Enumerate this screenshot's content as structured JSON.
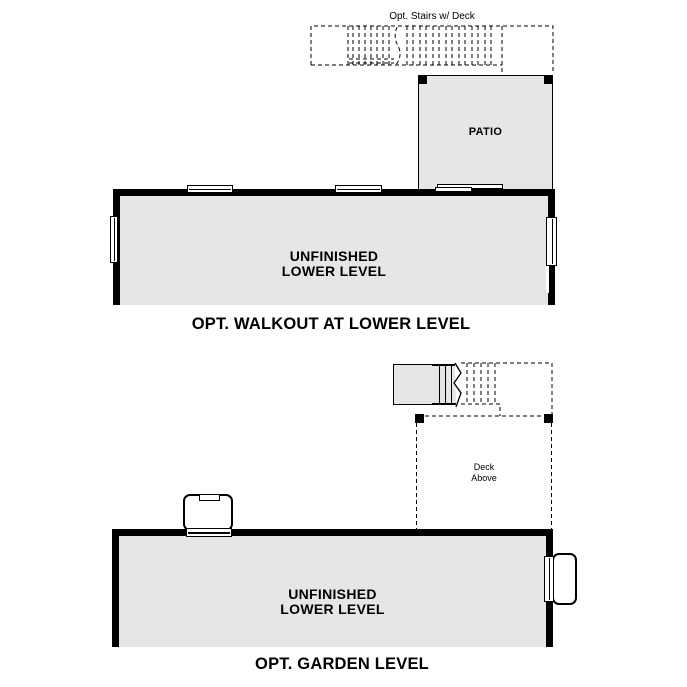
{
  "colors": {
    "room_fill": "#e6e6e6",
    "wall": "#000000",
    "background": "#ffffff"
  },
  "walkout": {
    "stairs_label": "Opt. Stairs w/ Deck",
    "patio_label": "PATIO",
    "room_label": [
      "UNFINISHED",
      "LOWER LEVEL"
    ],
    "caption": "OPT. WALKOUT AT LOWER LEVEL"
  },
  "garden": {
    "deck_label": [
      "Deck",
      "Above"
    ],
    "room_label": [
      "UNFINISHED",
      "LOWER LEVEL"
    ],
    "caption": "OPT. GARDEN LEVEL"
  }
}
